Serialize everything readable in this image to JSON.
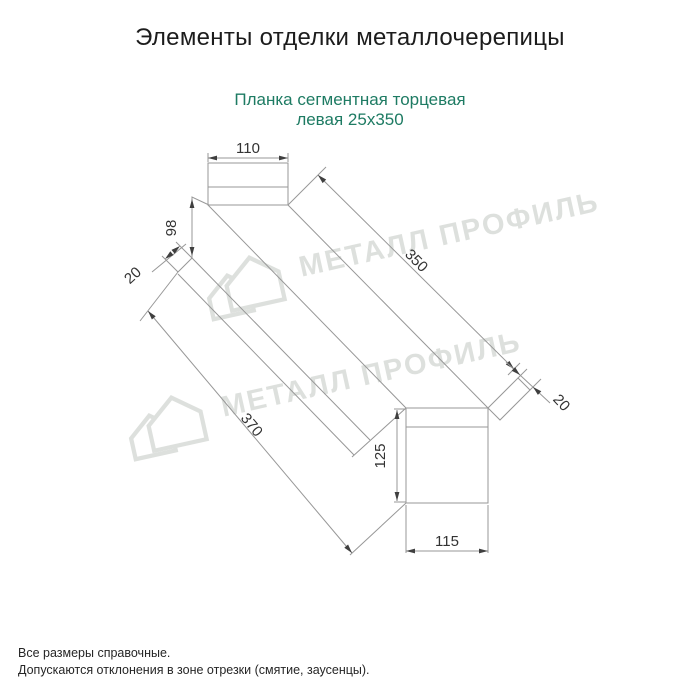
{
  "page": {
    "title": "Элементы отделки металлочерепицы"
  },
  "product": {
    "name_line1": "Планка сегментная торцевая",
    "name_line2": "левая 25x350"
  },
  "dimensions": {
    "top_width": "110",
    "left_height": "98",
    "left_fold": "20",
    "top_length": "350",
    "right_fold": "20",
    "bottom_length": "370",
    "right_height": "125",
    "bottom_width": "115"
  },
  "watermark": {
    "brand": "МЕТАЛЛ ПРОФИЛЬ"
  },
  "notes": {
    "line1": "Все размеры справочные.",
    "line2": "Допускаются отклонения в зоне отрезки (смятие, заусенцы)."
  },
  "colors": {
    "accent_teal": "#1e7b63",
    "drawing_line": "#979797",
    "dimension_text": "#333333",
    "watermark_gray": "#c3c8c3"
  }
}
